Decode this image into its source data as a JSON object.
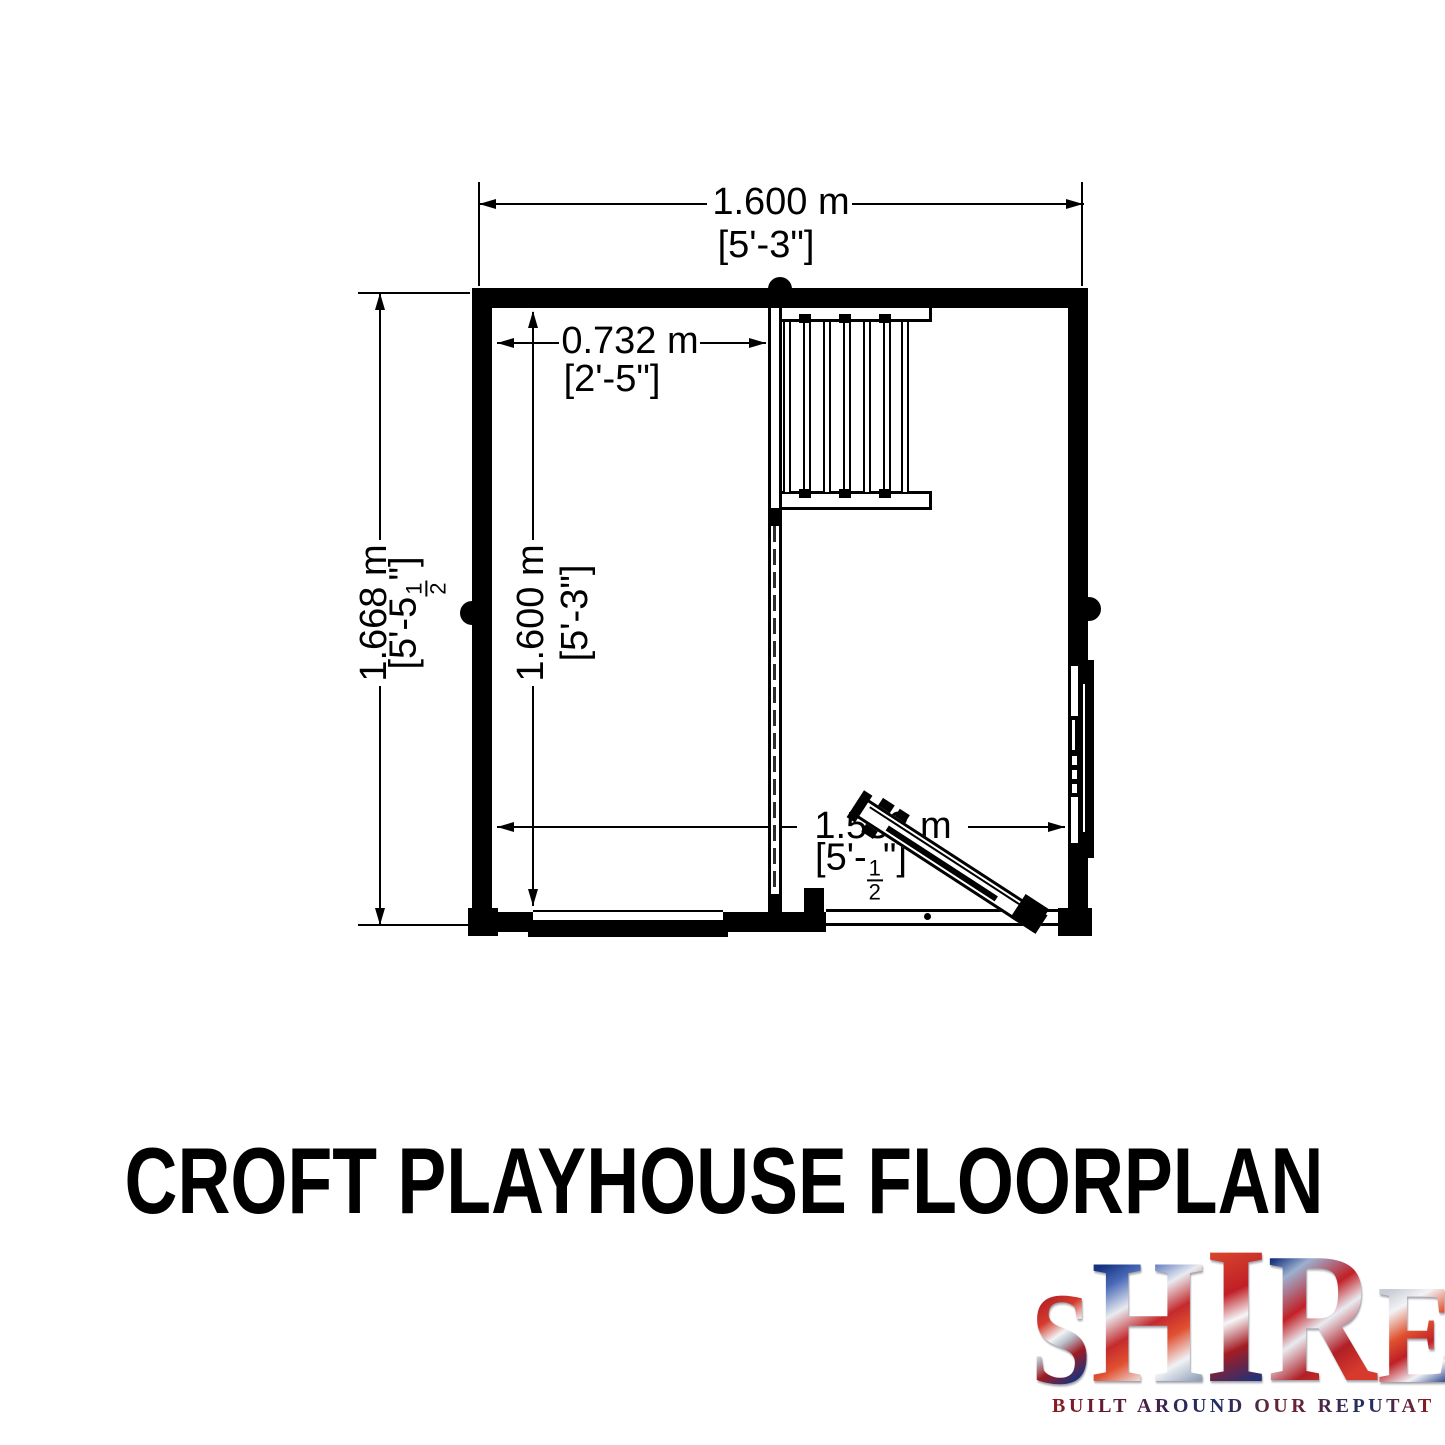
{
  "plan": {
    "dimensions": {
      "overall_width": {
        "metric": "1.600 m",
        "imperial": "[5'-3\"]"
      },
      "overall_depth": {
        "metric": "1.668 m",
        "imperial_prefix": "[5'-5",
        "fraction_numerator": "1",
        "fraction_denominator": "2",
        "imperial_suffix": "\"]"
      },
      "internal_depth": {
        "metric": "1.600 m",
        "imperial": "[5'-3\"]"
      },
      "left_room_width": {
        "metric": "0.732 m",
        "imperial": "[2'-5\"]"
      },
      "internal_width": {
        "metric": "1.532 m",
        "imperial_prefix": "[5'-",
        "fraction_numerator": "1",
        "fraction_denominator": "2",
        "imperial_suffix": "\"]"
      }
    },
    "features": [
      "loft-ladder",
      "partition-wall",
      "front-door",
      "right-window",
      "bottom-window"
    ]
  },
  "title": {
    "text": "CROFT PLAYHOUSE FLOORPLAN"
  },
  "logo": {
    "letters": [
      "S",
      "H",
      "I",
      "R",
      "E"
    ],
    "tagline": "BUILT AROUND OUR REPUTATION",
    "colors": {
      "red": "#c22026",
      "blue": "#1c3f8e",
      "silver": "#dfe3e8",
      "line": "#000000"
    }
  }
}
